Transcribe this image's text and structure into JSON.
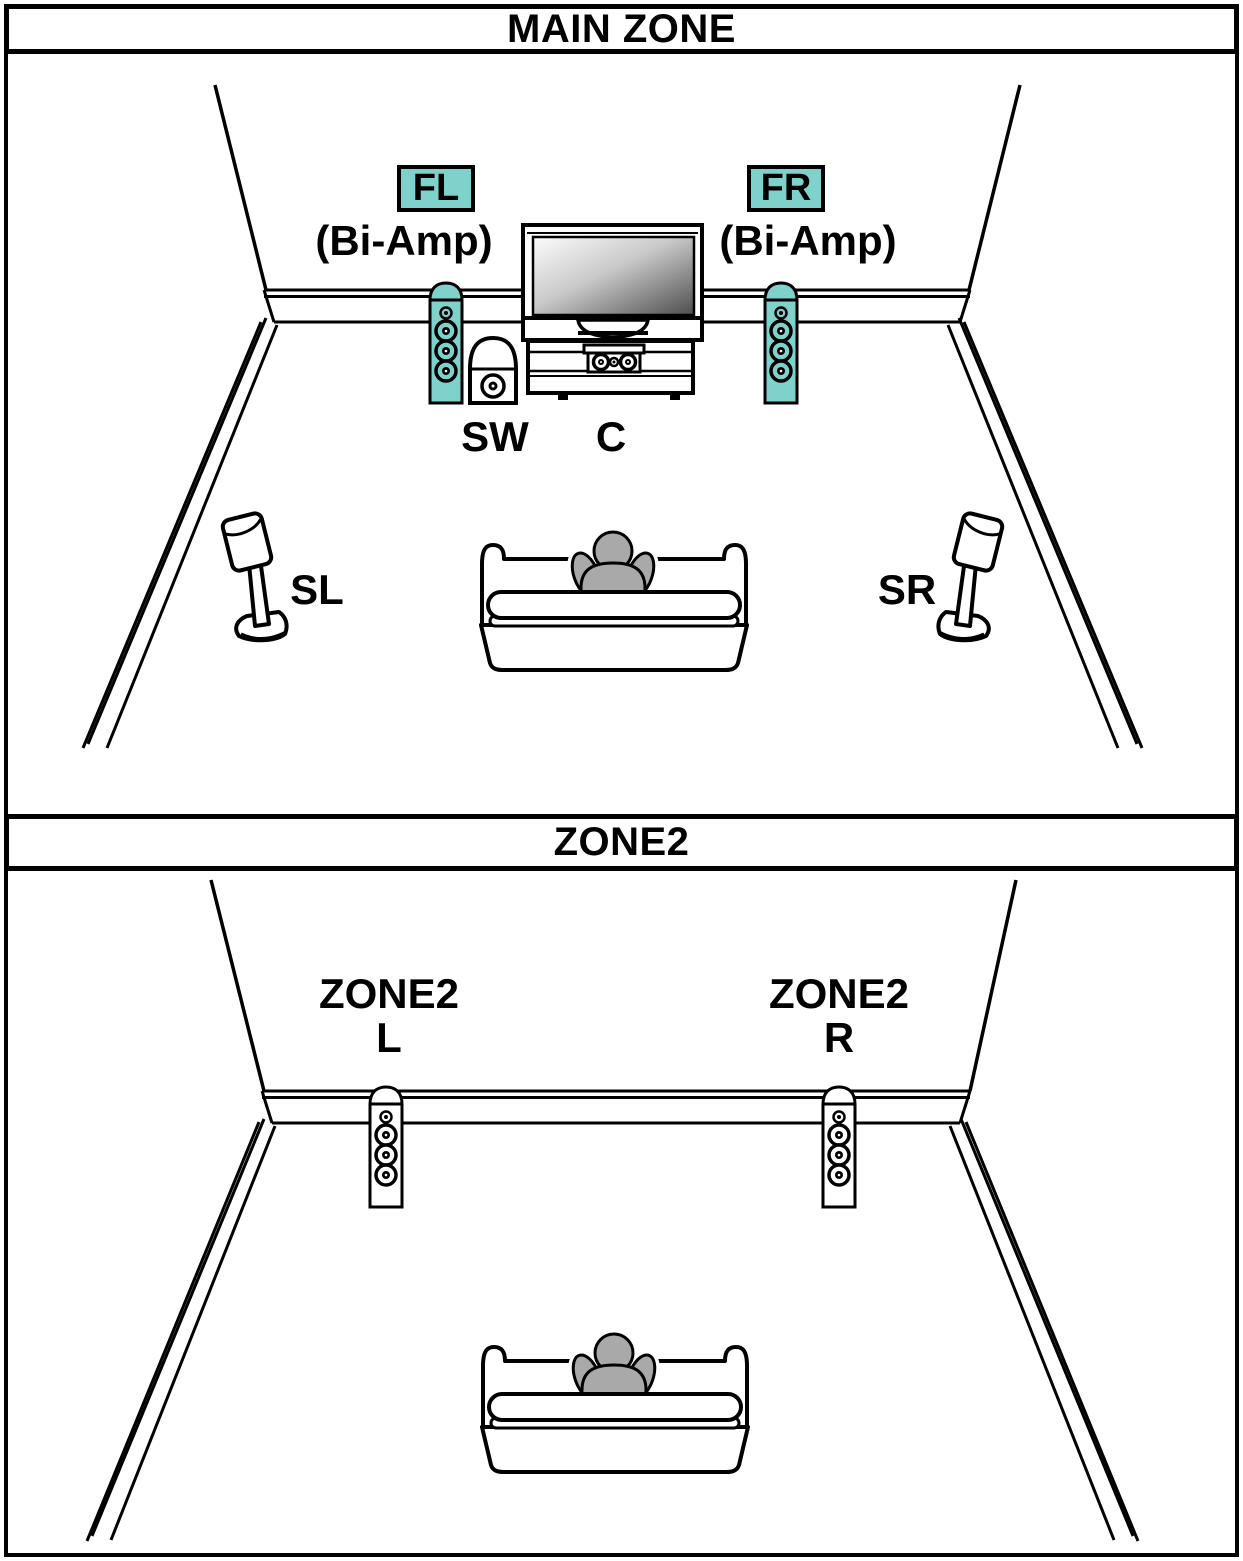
{
  "main_zone": {
    "title": "MAIN ZONE",
    "front_left": {
      "label": "FL",
      "mode": "(Bi-Amp)"
    },
    "front_right": {
      "label": "FR",
      "mode": "(Bi-Amp)"
    },
    "subwoofer_label": "SW",
    "center_label": "C",
    "surround_left_label": "SL",
    "surround_right_label": "SR"
  },
  "zone2": {
    "title": "ZONE2",
    "left_speaker": {
      "line1": "ZONE2",
      "line2": "L"
    },
    "right_speaker": {
      "line1": "ZONE2",
      "line2": "R"
    }
  },
  "colors": {
    "highlight_teal": "#7FD1CB",
    "speaker_white": "#FFFFFF",
    "person_gray": "#A9A9A9",
    "tv_screen_dark": "#4D4D4D"
  }
}
